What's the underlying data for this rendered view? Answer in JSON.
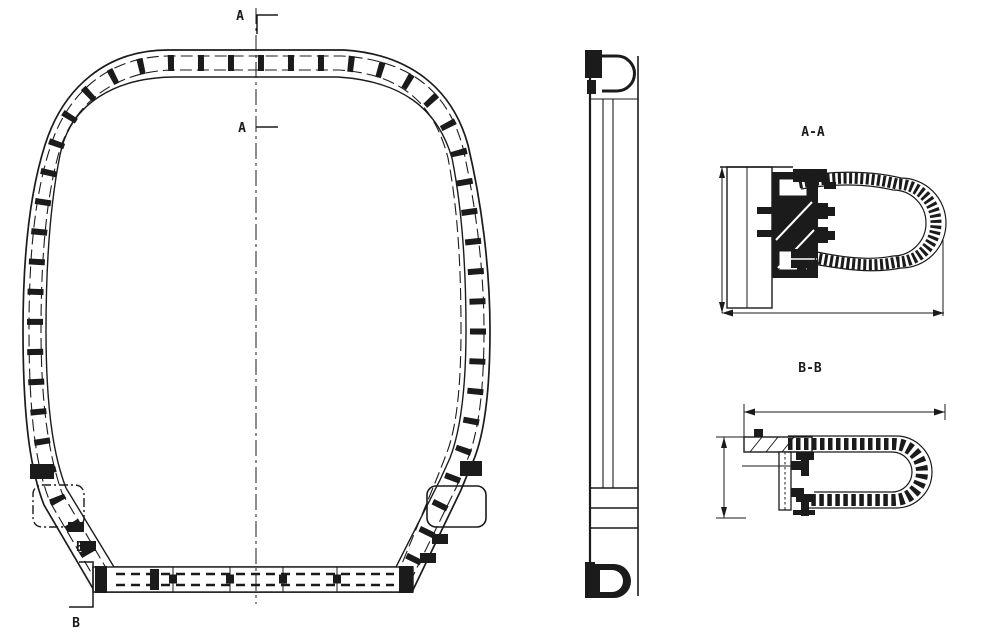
{
  "drawing": {
    "background": "#ffffff",
    "ink": "#1b1b1b",
    "front_view": {
      "marker_a_upper": "A",
      "marker_a_lower": "A",
      "marker_b_upper": "B",
      "marker_b_lower": "B"
    },
    "sections": {
      "aa_label": "A-A",
      "bb_label": "B-B"
    }
  }
}
